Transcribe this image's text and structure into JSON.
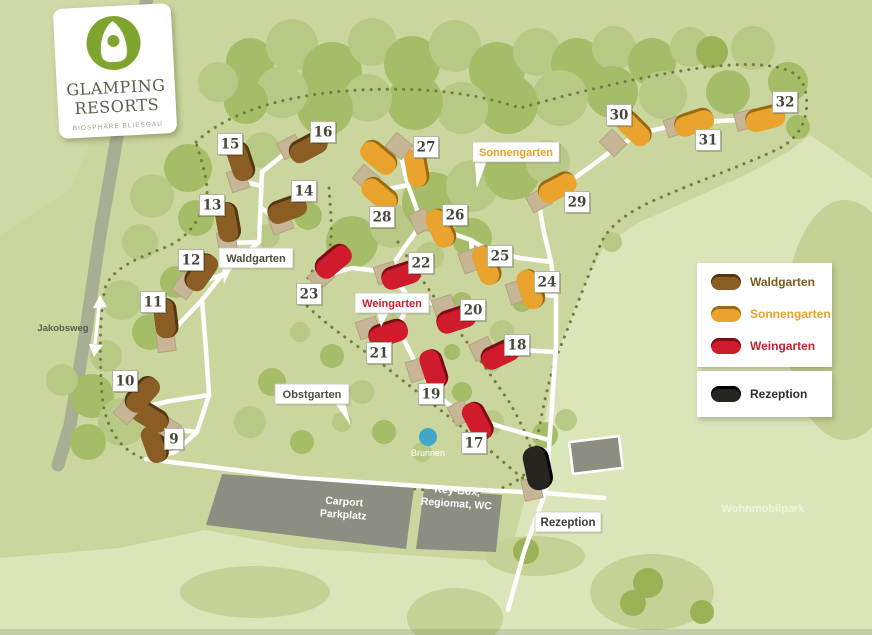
{
  "logo": {
    "line1": "GLAMPING",
    "line2": "RESORTS",
    "subtitle": "BIOSPHÄRE BLIESGAU"
  },
  "legend": {
    "items": [
      {
        "id": "waldgarten",
        "label": "Waldgarten",
        "tent_color": "#8a5d24",
        "text_color": "#7a5a1e"
      },
      {
        "id": "sonnengarten",
        "label": "Sonnengarten",
        "tent_color": "#eaa42d",
        "text_color": "#e8a128"
      },
      {
        "id": "weingarten",
        "label": "Weingarten",
        "tent_color": "#cf1b2b",
        "text_color": "#c41f30"
      }
    ],
    "reception": {
      "id": "rezeption",
      "label": "Rezeption",
      "tent_color": "#25241f",
      "text_color": "#2e2d28"
    }
  },
  "areas": [
    {
      "id": "waldgarten",
      "label": "Waldgarten",
      "x": 256,
      "y": 258,
      "color": "#4d4e40",
      "tail": "bl"
    },
    {
      "id": "sonnengarten",
      "label": "Sonnengarten",
      "x": 516,
      "y": 152,
      "color": "#e8a128",
      "tail": "bl2"
    },
    {
      "id": "weingarten",
      "label": "Weingarten",
      "x": 392,
      "y": 303,
      "color": "#c32031",
      "tail": "b"
    },
    {
      "id": "obstgarten",
      "label": "Obstgarten",
      "x": 312,
      "y": 394,
      "color": "#4d4e40",
      "tail": "br"
    }
  ],
  "poi_labels": [
    {
      "id": "jakobsweg",
      "text": "Jakobsweg",
      "x": 63,
      "y": 331,
      "color": "#5a5c4e",
      "size": 9.5,
      "bold": true,
      "rot": 0
    },
    {
      "id": "brunnen",
      "text": "Brunnen",
      "x": 428,
      "y": 456,
      "color": "#ffffff",
      "size": 9,
      "bold": false,
      "rot": 0
    },
    {
      "id": "carport",
      "text": "Carport\nParkplatz",
      "x": 344,
      "y": 505,
      "color": "#ffffff",
      "size": 10.5,
      "bold": true,
      "rot": 4
    },
    {
      "id": "keybox",
      "text": "Key-Box,\nRegiomat, WC",
      "x": 457,
      "y": 494,
      "color": "#ffffff",
      "size": 10.5,
      "bold": true,
      "rot": 4
    },
    {
      "id": "wohnmobilpark",
      "text": "Wohnmobilpark",
      "x": 763,
      "y": 512,
      "color": "#eef3da",
      "size": 11,
      "bold": true,
      "rot": 0
    }
  ],
  "reception_plate": {
    "label": "Rezeption",
    "x": 568,
    "y": 522
  },
  "tents": [
    {
      "n": "9",
      "g": "wald",
      "x": 150,
      "y": 416,
      "rot": 32,
      "px": 168,
      "py": 428,
      "lx": 174,
      "ly": 439
    },
    {
      "n": "10",
      "g": "wald",
      "x": 142,
      "y": 394,
      "rot": -48,
      "px": 127,
      "py": 411,
      "lx": 125,
      "ly": 381
    },
    {
      "n": "11",
      "g": "wald",
      "x": 166,
      "y": 318,
      "rot": 83,
      "px": 166,
      "py": 341,
      "lx": 153,
      "ly": 302
    },
    {
      "n": "12",
      "g": "wald",
      "x": 201,
      "y": 272,
      "rot": -55,
      "px": 185,
      "py": 286,
      "lx": 191,
      "ly": 260
    },
    {
      "n": "13",
      "g": "wald",
      "x": 228,
      "y": 222,
      "rot": 80,
      "px": 227,
      "py": 242,
      "lx": 212,
      "ly": 205
    },
    {
      "n": "14",
      "g": "wald",
      "x": 287,
      "y": 209,
      "rot": -20,
      "px": 281,
      "py": 223,
      "lx": 304,
      "ly": 191
    },
    {
      "n": "15",
      "g": "wald",
      "x": 241,
      "y": 161,
      "rot": 72,
      "px": 238,
      "py": 180,
      "lx": 230,
      "ly": 144
    },
    {
      "n": "16",
      "g": "wald",
      "x": 308,
      "y": 147,
      "rot": -28,
      "px": 290,
      "py": 147,
      "lx": 323,
      "ly": 132
    },
    {
      "n": "17",
      "g": "wein",
      "x": 478,
      "y": 421,
      "rot": 62,
      "px": 460,
      "py": 413,
      "lx": 474,
      "ly": 443
    },
    {
      "n": "18",
      "g": "wein",
      "x": 500,
      "y": 354,
      "rot": -25,
      "px": 482,
      "py": 349,
      "lx": 517,
      "ly": 345
    },
    {
      "n": "19",
      "g": "wein",
      "x": 434,
      "y": 369,
      "rot": 72,
      "px": 417,
      "py": 370,
      "lx": 431,
      "ly": 394
    },
    {
      "n": "20",
      "g": "wein",
      "x": 456,
      "y": 319,
      "rot": -18,
      "px": 444,
      "py": 306,
      "lx": 473,
      "ly": 310
    },
    {
      "n": "21",
      "g": "wein",
      "x": 388,
      "y": 333,
      "rot": -18,
      "px": 368,
      "py": 328,
      "lx": 379,
      "ly": 353
    },
    {
      "n": "22",
      "g": "wein",
      "x": 401,
      "y": 275,
      "rot": -18,
      "px": 386,
      "py": 273,
      "lx": 421,
      "ly": 263
    },
    {
      "n": "23",
      "g": "wein",
      "x": 333,
      "y": 261,
      "rot": -40,
      "px": 321,
      "py": 277,
      "lx": 309,
      "ly": 294
    },
    {
      "n": "24",
      "g": "sonnen",
      "x": 531,
      "y": 289,
      "rot": 72,
      "px": 517,
      "py": 292,
      "lx": 547,
      "ly": 282
    },
    {
      "n": "25",
      "g": "sonnen",
      "x": 487,
      "y": 265,
      "rot": 70,
      "px": 470,
      "py": 261,
      "lx": 500,
      "ly": 256
    },
    {
      "n": "26",
      "g": "sonnen",
      "x": 441,
      "y": 228,
      "rot": 65,
      "px": 421,
      "py": 221,
      "lx": 455,
      "ly": 215
    },
    {
      "n": "27",
      "g": "sonnen",
      "x": 379,
      "y": 157,
      "rot": 40,
      "px": 399,
      "py": 146,
      "lx": 426,
      "ly": 147
    },
    {
      "n": "28",
      "g": "sonnen",
      "x": 380,
      "y": 194,
      "rot": 40,
      "px": 366,
      "py": 178,
      "lx": 382,
      "ly": 217
    },
    {
      "n": "29",
      "g": "sonnen",
      "x": 557,
      "y": 187,
      "rot": -28,
      "px": 539,
      "py": 200,
      "lx": 577,
      "ly": 202
    },
    {
      "n": "30",
      "g": "sonnen",
      "x": 634,
      "y": 128,
      "rot": 45,
      "px": 613,
      "py": 143,
      "lx": 619,
      "ly": 115
    },
    {
      "n": "31",
      "g": "sonnen",
      "x": 694,
      "y": 122,
      "rot": -18,
      "px": 676,
      "py": 126,
      "lx": 708,
      "ly": 140
    },
    {
      "n": "32",
      "g": "sonnen",
      "x": 765,
      "y": 118,
      "rot": -14,
      "px": 746,
      "py": 120,
      "lx": 785,
      "ly": 102
    }
  ],
  "extra_tent_bodies": [
    {
      "g": "sonnen",
      "x": 417,
      "y": 168,
      "rot": 80
    },
    {
      "g": "wald",
      "x": 155,
      "y": 444,
      "rot": 70
    }
  ],
  "reception_tent": {
    "g": "rez",
    "x": 538,
    "y": 468,
    "rot": 78,
    "px": 532,
    "py": 489
  },
  "map_colors": {
    "background": "#cbd69e",
    "meadow": "#dbe5ba",
    "meadow_blob": "#c6d195",
    "tree_light": "#b8c986",
    "tree_mid": "#a6bd68",
    "tree_dark": "#9cb257",
    "road": "#ffffff",
    "boundary_dots": "#6f7c41",
    "trail": "#a8ae94",
    "building": "#8d8e82",
    "porch": "#c7b695",
    "well_blue": "#42a7c9",
    "wald": "#8a5d24",
    "wald_dark": "#53380f",
    "sonnen": "#eaa42d",
    "sonnen_dark": "#9a6a10",
    "wein": "#cf1b2b",
    "wein_dark": "#7c0d16",
    "rez": "#25241f",
    "rez_dark": "#000000",
    "plate_text": "#45453a"
  }
}
